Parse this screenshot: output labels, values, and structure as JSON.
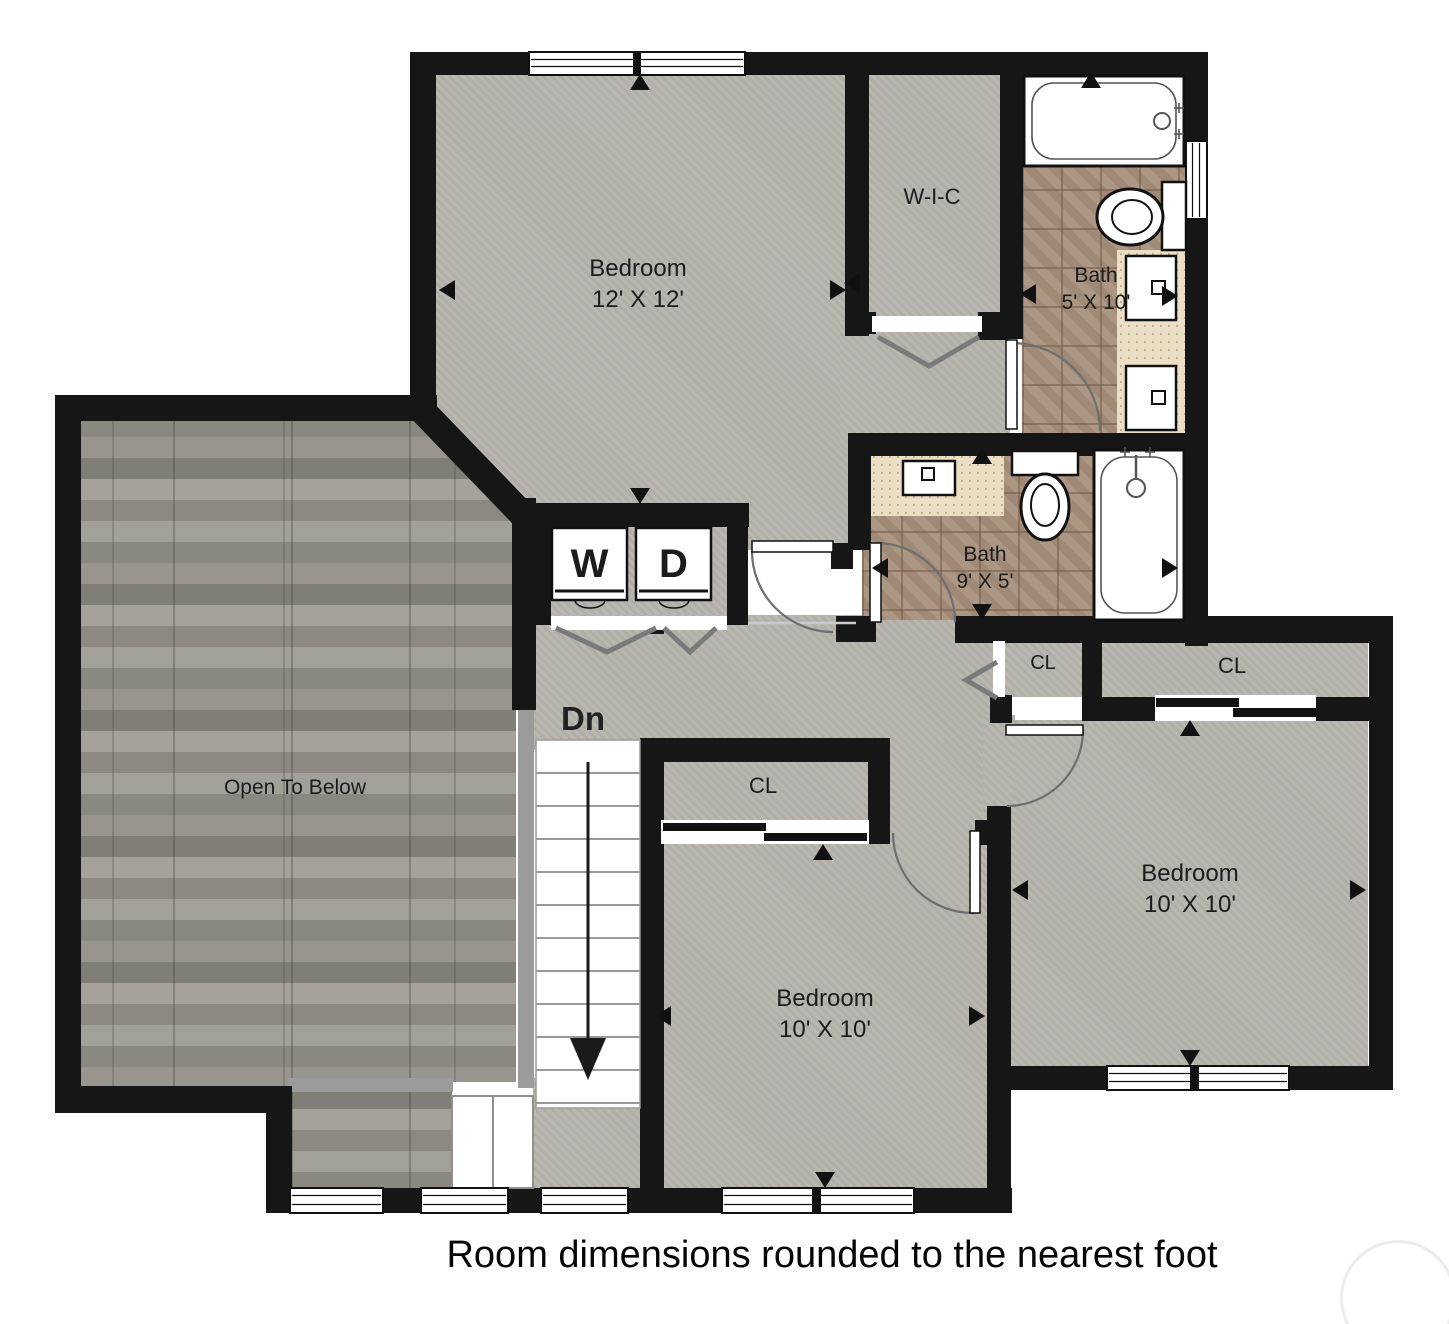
{
  "footer": {
    "note": "Room dimensions rounded to the nearest foot"
  },
  "colors": {
    "wall": "#161616",
    "floor_gray": "#b7b4ae",
    "tile_brown": "#a8917d",
    "vanity_beige": "#ebe0c6",
    "wood_gray": "#8f8c86",
    "railing_gray": "#9b9b9b",
    "fixture_white": "#ffffff",
    "door_arc_gray": "#6e6e6e"
  },
  "rooms": {
    "bedroom_main": {
      "name": "Bedroom",
      "dims": "12' X 12'"
    },
    "walk_in_closet": {
      "name": "W-I-C"
    },
    "bath_upper": {
      "name": "Bath",
      "dims": "5' X 10'"
    },
    "bath_hall": {
      "name": "Bath",
      "dims": "9' X 5'"
    },
    "open_to_below": {
      "name": "Open To Below"
    },
    "bedroom_middle": {
      "name": "Bedroom",
      "dims": "10' X 10'"
    },
    "bedroom_right": {
      "name": "Bedroom",
      "dims": "10' X 10'"
    },
    "closet_middle": {
      "name": "CL"
    },
    "closet_hall": {
      "name": "CL"
    },
    "closet_right": {
      "name": "CL"
    }
  },
  "stairs": {
    "label": "Dn"
  },
  "laundry": {
    "washer_label": "W",
    "dryer_label": "D"
  }
}
